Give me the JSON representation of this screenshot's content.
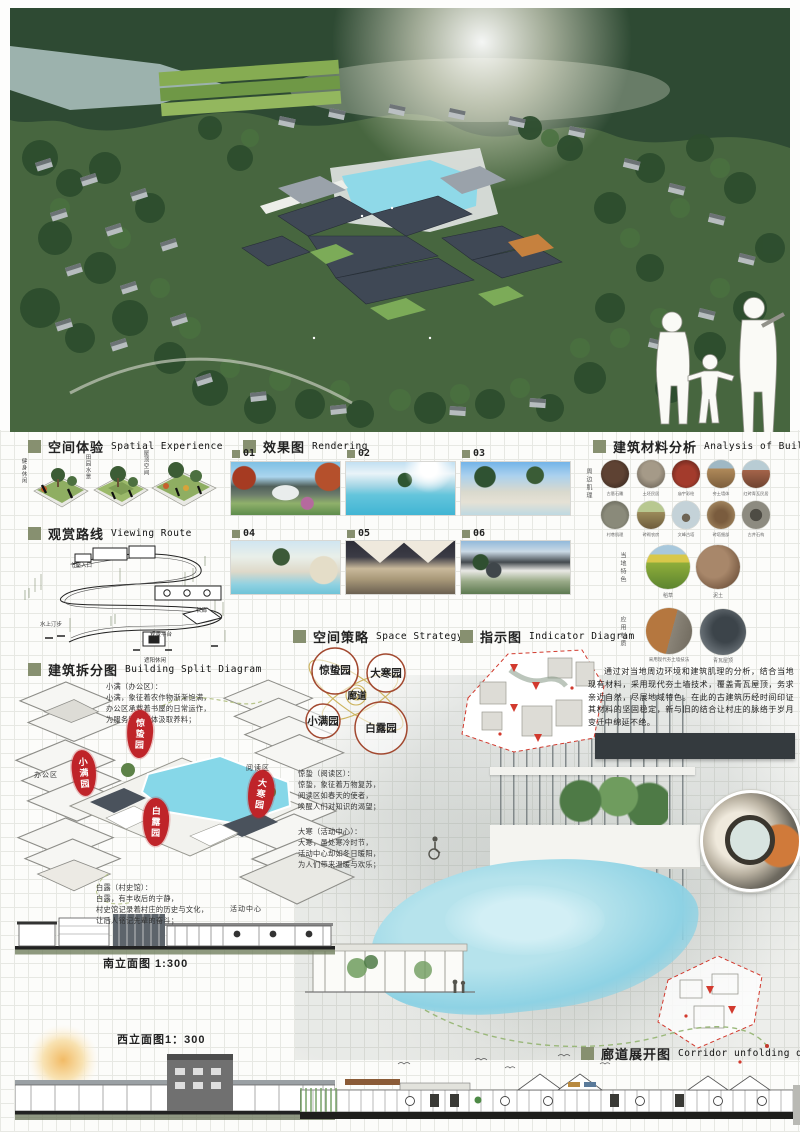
{
  "board": {
    "accent_color": "#879070",
    "stamp_color": "#bf2429",
    "pond_color": "#86d7e8",
    "hero_alt": "鸟瞰效果图"
  },
  "sections": {
    "spatial": {
      "zh": "空间体验",
      "en": "Spatial Experience",
      "items": [
        {
          "label": "健身休闲"
        },
        {
          "label": "田园水景"
        },
        {
          "label": "屋顶空间"
        }
      ]
    },
    "route": {
      "zh": "观赏路线",
      "en": "Viewing Route",
      "labels": [
        {
          "t": "书屋入口"
        },
        {
          "t": "长廊"
        },
        {
          "t": "水上汀步"
        },
        {
          "t": "观景平台"
        },
        {
          "t": "遮阳休闲"
        }
      ]
    },
    "split": {
      "zh": "建筑拆分图",
      "en": "Building Split Diagram",
      "stamps": [
        {
          "t": "惊蛰园"
        },
        {
          "t": "小满园"
        },
        {
          "t": "白露园"
        },
        {
          "t": "大寒园"
        }
      ],
      "zones": [
        {
          "t": "办公区"
        },
        {
          "t": "阅读区"
        },
        {
          "t": "活动中心"
        }
      ],
      "notes": [
        {
          "t": "小满（办公区）：\n小满，象征着农作物渐渐饱满，\n办公区承载着书屋的日常运作，\n为服务留守群体汲取养料；"
        },
        {
          "t": "惊蛰（阅读区）：\n惊蛰，象征着万物复苏，\n阅读区如春天的使者，\n唤醒人们对知识的渴望；"
        },
        {
          "t": "大寒（活动中心）：\n大寒，虽处寒冷时节，\n活动中心却如冬日暖阳，\n为人们带来温暖与欢乐；"
        },
        {
          "t": "白露（村史馆）：\n白露，有丰收后的宁静，\n村史馆记录着村庄的历史与文化，\n让后人铭记先辈的奋斗；"
        }
      ]
    },
    "rendering": {
      "zh": "效果图",
      "en": "Rendering",
      "ids": [
        "01",
        "02",
        "03",
        "04",
        "05",
        "06"
      ]
    },
    "strategy": {
      "zh": "空间策略",
      "en": "Space Strategy",
      "bubbles": [
        {
          "t": "惊蛰园"
        },
        {
          "t": "大寒园"
        },
        {
          "t": "廊道"
        },
        {
          "t": "小满园"
        },
        {
          "t": "白露园"
        }
      ]
    },
    "indicator": {
      "zh": "指示图",
      "en": "Indicator Diagram"
    },
    "materials": {
      "zh": "建筑材料分析",
      "en": "Analysis of Building Materials",
      "side_labels": [
        {
          "t": "周边肌理"
        },
        {
          "t": "当地特色"
        },
        {
          "t": "应用材质"
        }
      ],
      "captions": [
        {
          "t": "古厝石雕"
        },
        {
          "t": "土坯民居"
        },
        {
          "t": "庙宇彩绘"
        },
        {
          "t": "夯土墙体"
        },
        {
          "t": "红砖青瓦民居"
        },
        {
          "t": "村巷肌理"
        },
        {
          "t": "砖砌农房"
        },
        {
          "t": "文峰古塔"
        },
        {
          "t": "砖塔细部"
        },
        {
          "t": "古井石构"
        }
      ],
      "featured": [
        {
          "t": "稻草"
        },
        {
          "t": "泥土"
        },
        {
          "t": "采用现代夯土墙技法"
        },
        {
          "t": "青瓦屋顶"
        }
      ],
      "paragraph": "通过对当地周边环境和建筑肌理的分析，结合当地现有材料，采用现代夯土墙技术，覆盖青瓦屋顶，务求亲近自然，尽展地域特色。在此的古建筑历经时间印证其材料的坚固稳定，新与旧的结合让村庄的脉络于岁月变迁中绵延不绝。"
    },
    "south_elev": {
      "label": "南立面图  1:300"
    },
    "west_elev": {
      "label": "西立面图1：300"
    },
    "corridor": {
      "zh": "廊道展开图",
      "en": "Corridor unfolding diagram"
    }
  }
}
